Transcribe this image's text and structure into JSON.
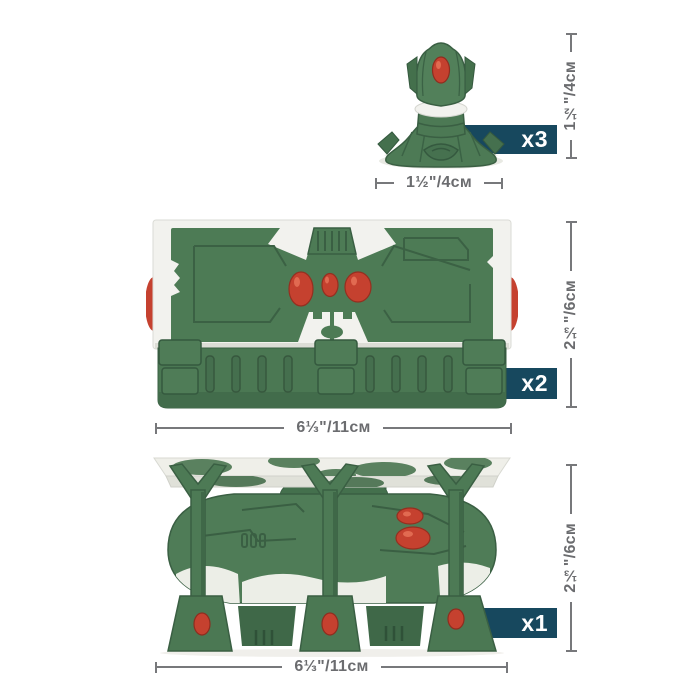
{
  "colors": {
    "badge_bg": "#17485e",
    "badge_text": "#ffffff",
    "dimension_line": "#77787b",
    "dimension_text": "#6b6c6f",
    "model_green": "#4f7c57",
    "model_green_dark": "#3a5f43",
    "model_white": "#f2f2ee",
    "model_red": "#c5412f",
    "background": "#ffffff"
  },
  "items": [
    {
      "id": "turret",
      "count_label": "x3",
      "height_label": "1½\"/4см",
      "width_label": "1½\"/4см"
    },
    {
      "id": "bunker",
      "count_label": "x2",
      "height_label": "2⅓\"/6см",
      "width_label": "6⅓\"/11см"
    },
    {
      "id": "landing_pad",
      "count_label": "x1",
      "height_label": "2⅓\"/6см",
      "width_label": "6⅓\"/11см"
    }
  ]
}
